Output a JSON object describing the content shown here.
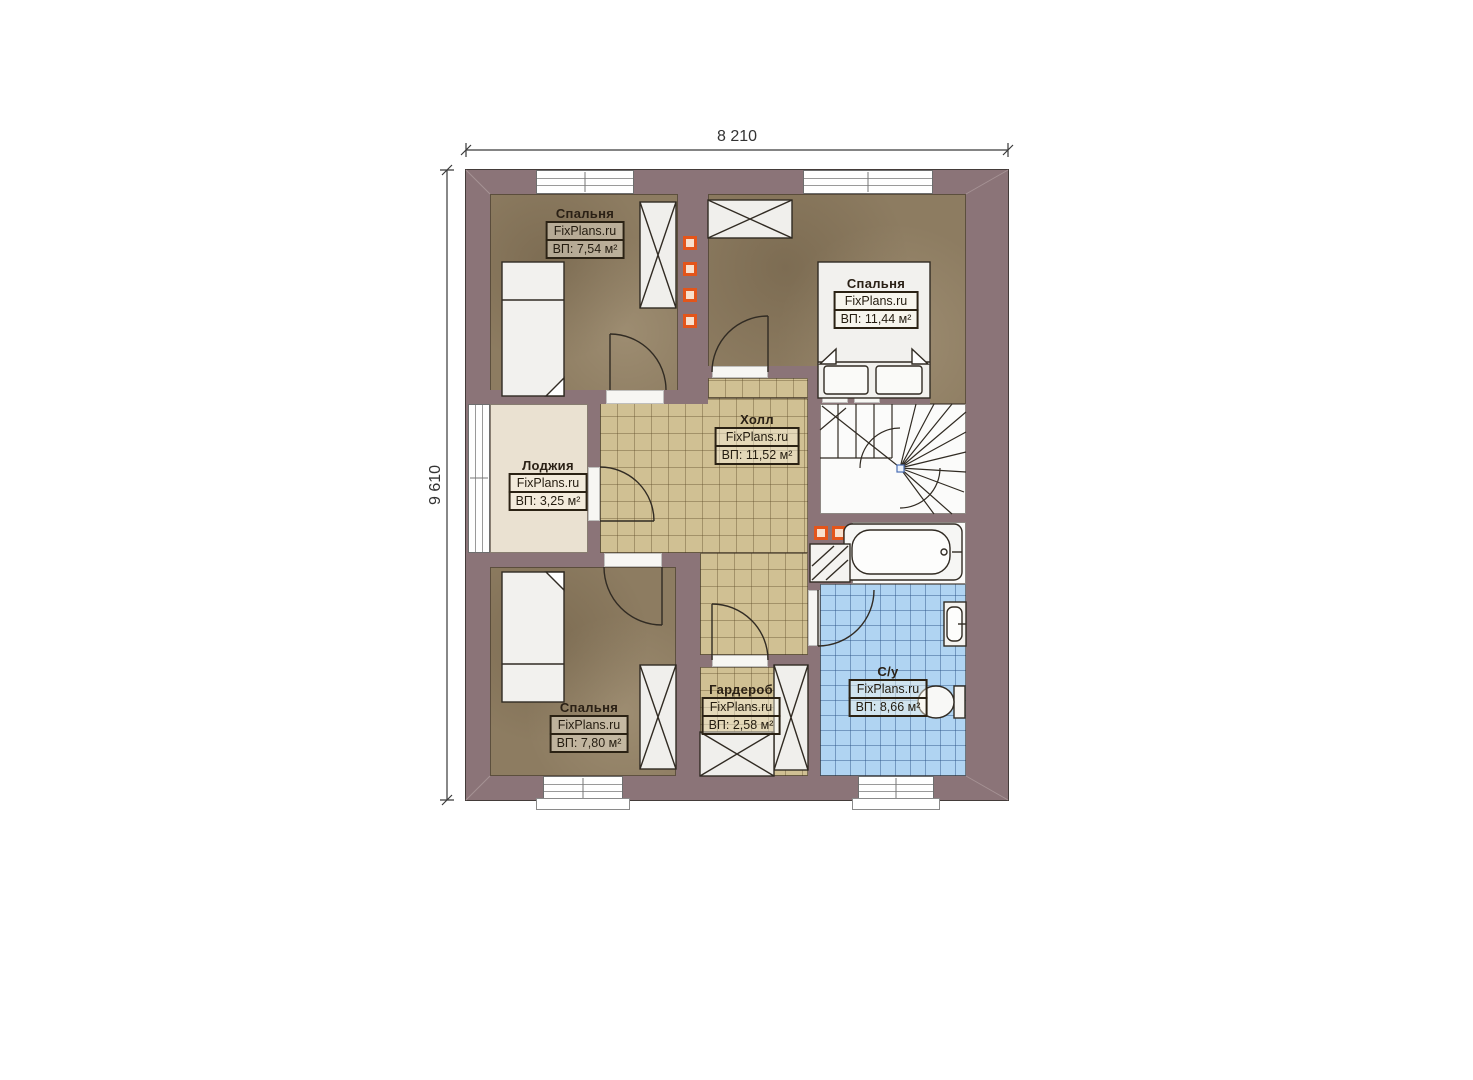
{
  "dimensions": {
    "width": "8 210",
    "height": "9 610"
  },
  "brand_label": "FixPlans.ru",
  "rooms": [
    {
      "id": "bedroom-top-left",
      "name": "Спальня",
      "area": "ВП: 7,54 м²"
    },
    {
      "id": "bedroom-top-right",
      "name": "Спальня",
      "area": "ВП: 11,44 м²"
    },
    {
      "id": "hall",
      "name": "Холл",
      "area": "ВП: 11,52 м²"
    },
    {
      "id": "loggia",
      "name": "Лоджия",
      "area": "ВП: 3,25 м²"
    },
    {
      "id": "bedroom-bottom-left",
      "name": "Спальня",
      "area": "ВП: 7,80 м²"
    },
    {
      "id": "wardrobe-room",
      "name": "Гардероб",
      "area": "ВП: 2,58 м²"
    },
    {
      "id": "bathroom",
      "name": "С/у",
      "area": "ВП: 8,66 м²"
    }
  ],
  "colors": {
    "wall": "#8b7478",
    "bedroom_floor": "#8d7c61",
    "tile_floor": "#d0c093",
    "loggia_floor": "#eae1d1",
    "bath_floor": "#b0d4f2",
    "furniture": "#f2f1ee",
    "vent_accent": "#e3551b",
    "line": "#312b23"
  }
}
